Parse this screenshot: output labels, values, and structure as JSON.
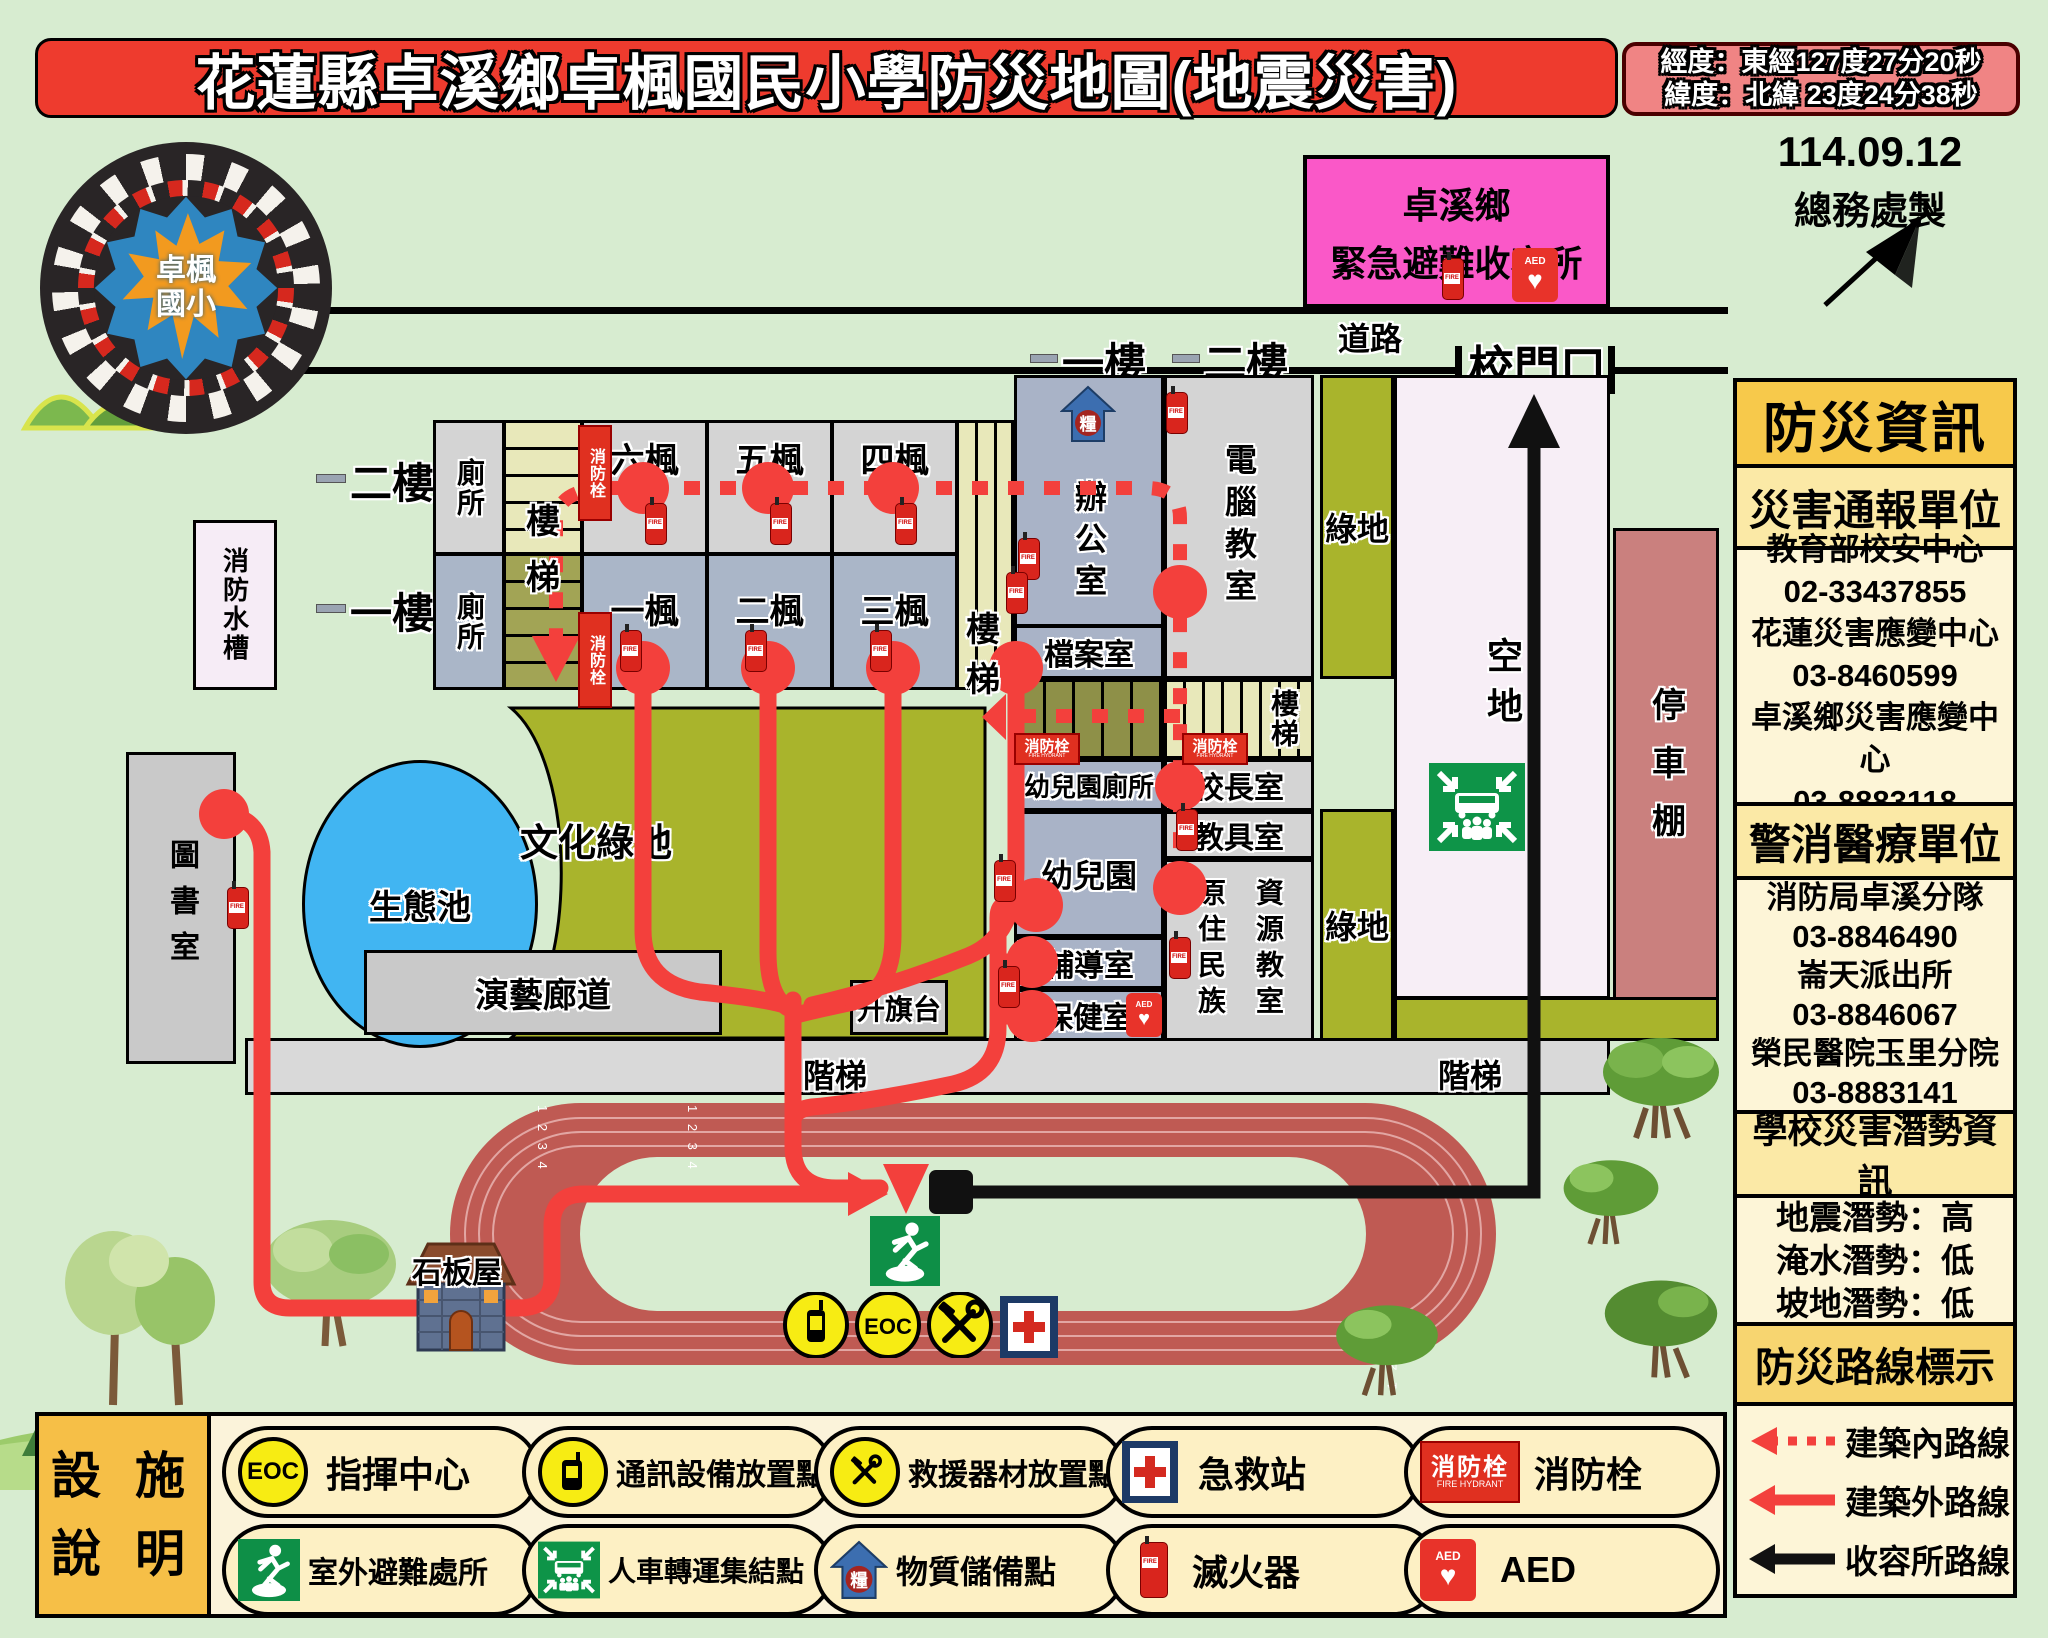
{
  "title": "花蓮縣卓溪鄉卓楓國民小學防災地圖(地震災害)",
  "coords": {
    "lng": "經度：東經127度27分20秒",
    "lat": "緯度：北緯 23度24分38秒"
  },
  "made": {
    "date": "114.09.12",
    "by": "總務處製"
  },
  "compass_n": "N",
  "logo": {
    "line1": "卓楓",
    "line2": "國小"
  },
  "shelter": {
    "line1": "卓溪鄉",
    "line2": "緊急避難收容所"
  },
  "map": {
    "road": "道路",
    "gate": "校門口",
    "floor1": "一樓",
    "floor2": "二樓",
    "lane_numbers": "1 2 3 4",
    "rooms": {
      "toilet": "廁所",
      "room6": "六楓",
      "room5": "五楓",
      "room4": "四楓",
      "room1": "一楓",
      "room2": "二楓",
      "room3": "三楓",
      "lou": "樓",
      "ti": "梯",
      "stairs": "樓梯",
      "water_tank": "消防水槽",
      "office": "辦公室",
      "archive": "檔案室",
      "computer": "電腦教室",
      "green": "綠地",
      "open": "空地",
      "parking": "停車棚",
      "kg_toilet": "幼兒園廁所",
      "principal": "校長室",
      "teaching_aids": "教具室",
      "kindergarten": "幼兒園",
      "indigenous": "原住民族",
      "resource": "資源教室",
      "counseling": "輔導室",
      "health": "保健室",
      "library": "圖書室",
      "pond": "生態池",
      "culture": "文化綠地",
      "gallery": "演藝廊道",
      "flag": "升旗台",
      "steps": "階梯",
      "stone_house": "石板屋"
    }
  },
  "signs": {
    "hydrant_zh": "消防栓",
    "hydrant_en": "FIRE HYDRANT"
  },
  "icons": {
    "eoc": "EOC",
    "aed": "AED",
    "supply": "糧"
  },
  "sidebar": {
    "title": "防災資訊",
    "s1": {
      "header": "災害通報單位",
      "lines": [
        "教育部校安中心",
        "02-33437855",
        "花蓮災害應變中心",
        "03-8460599",
        "卓溪鄉災害應變中心",
        "03-8883118"
      ]
    },
    "s2": {
      "header": "警消醫療單位",
      "lines": [
        "消防局卓溪分隊",
        "03-8846490",
        "崙天派出所",
        "03-8846067",
        "榮民醫院玉里分院",
        "03-8883141"
      ]
    },
    "s3": {
      "header": "學校災害潛勢資訊",
      "lines": [
        "地震潛勢：高",
        "淹水潛勢：低",
        "坡地潛勢：低"
      ]
    },
    "s4": {
      "header": "防災路線標示",
      "routes": [
        {
          "label": "建築內路線"
        },
        {
          "label": "建築外路線"
        },
        {
          "label": "收容所路線"
        }
      ]
    }
  },
  "facility": {
    "header1": "設 施",
    "header2": "說 明",
    "row1": [
      {
        "label": "指揮中心"
      },
      {
        "label": "通訊設備放置點"
      },
      {
        "label": "救援器材放置點"
      },
      {
        "label": "急救站"
      },
      {
        "label": "消防栓"
      }
    ],
    "row2": [
      {
        "label": "室外避難處所"
      },
      {
        "label": "人車轉運集結點"
      },
      {
        "label": "物質儲備點"
      },
      {
        "label": "滅火器"
      },
      {
        "label": "AED"
      }
    ]
  },
  "colors": {
    "route_red": "#f3403c",
    "route_black": "#111111",
    "shelter_pink": "#fa58c8",
    "accent_yellow": "#f6c84b",
    "olive_green": "#a9b42c",
    "title_red": "#ee3b2e"
  }
}
